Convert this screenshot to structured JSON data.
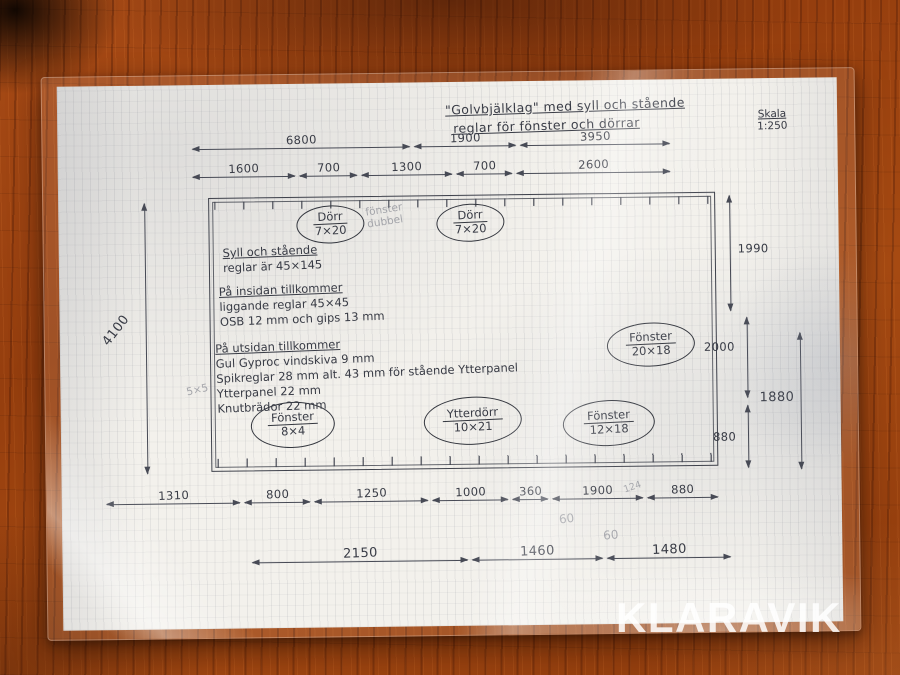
{
  "watermark": "KLARAVIK",
  "drawing": {
    "title_line1": "\"Golvbjälklag\" med syll och stående",
    "title_line2": "reglar för fönster och dörrar",
    "scale_label": "Skala",
    "scale_value": "1:250",
    "openings": [
      {
        "label": "Dörr",
        "size": "7×20"
      },
      {
        "label": "Dörr",
        "size": "7×20"
      },
      {
        "label": "Fönster",
        "size": "20×18"
      },
      {
        "label": "Fönster",
        "size": "8×4"
      },
      {
        "label": "Ytterdörr",
        "size": "10×21"
      },
      {
        "label": "Fönster",
        "size": "12×18"
      }
    ],
    "notes": {
      "syll_line1": "Syll och stående",
      "syll_line2": "reglar är 45×145",
      "insida_heading": "På insidan tillkommer",
      "insida_lines": [
        "liggande reglar 45×45",
        "OSB 12 mm och gips 13 mm"
      ],
      "utsida_heading": "På utsidan tillkommer",
      "utsida_lines": [
        "Gul Gyproc vindskiva 9 mm",
        "Spikreglar 28 mm alt. 43 mm för stående Ytterpanel",
        "Ytterpanel 22 mm",
        "Knutbrädor 22 mm"
      ],
      "pencil_dubbel": "fönster\ndubbel",
      "pencil_5x5": "5×5",
      "pencil_60a": "60",
      "pencil_60b": "60",
      "pencil_124": "124"
    },
    "dims": {
      "top1": [
        "6800",
        "1900",
        "3950"
      ],
      "top2": [
        "1600",
        "700",
        "1300",
        "700",
        "2600"
      ],
      "left": "4100",
      "right": [
        "1990",
        "2000",
        "880",
        "1880"
      ],
      "bottom1": [
        "1310",
        "800",
        "1250",
        "1000",
        "360",
        "1900",
        "880"
      ],
      "bottom2": [
        "2150",
        "1460",
        "1480"
      ]
    }
  }
}
